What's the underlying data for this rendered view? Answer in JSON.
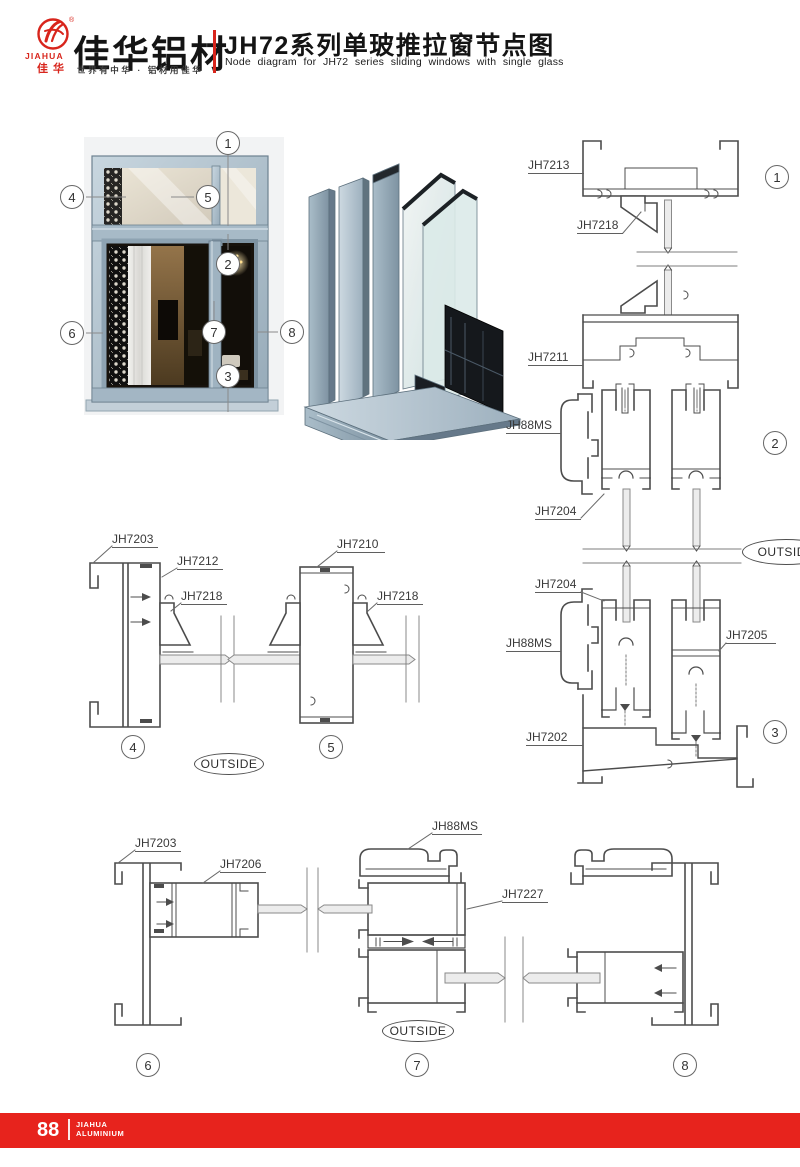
{
  "header": {
    "logo": {
      "brand_en": "JIAHUA",
      "brand_cn": "佳华",
      "reg": "®"
    },
    "brand_title": "佳华铝材",
    "brand_tagline": "世界有中华 · 铝材用佳华",
    "doc_title_cn": "JH72系列单玻推拉窗节点图",
    "doc_title_en": "Node diagram for JH72 series sliding windows with single glass",
    "accent_color": "#d8251c"
  },
  "callouts": {
    "c1": "1",
    "c2": "2",
    "c3": "3",
    "c4": "4",
    "c5": "5",
    "c6": "6",
    "c7": "7",
    "c8": "8"
  },
  "part_labels": {
    "s1_frame_top": "JH7213",
    "s1_gasket": "JH7218",
    "s2_transom": "JH7211",
    "s2_hook": "JH88MS",
    "s2_sash": "JH7204",
    "s3_sash": "JH7204",
    "s3_hook": "JH88MS",
    "s3_sash_right": "JH7205",
    "s3_sill": "JH7202",
    "s4_frame": "JH7203",
    "s4_bead": "JH7212",
    "s4_gasket": "JH7218",
    "s5_mullion": "JH7210",
    "s5_gasket": "JH7218",
    "s6_frame": "JH7203",
    "s6_sash": "JH7206",
    "s7_hook": "JH88MS",
    "s7_sash": "JH7227"
  },
  "outside_label": "OUTSIDE",
  "drawing": {
    "line_color": "#4c4c4c",
    "frame_color": "#a9bcc9"
  },
  "footer": {
    "page_number": "88",
    "brand_line1": "JIAHUA",
    "brand_line2": "ALUMINIUM",
    "bar_color": "#e7231d"
  }
}
